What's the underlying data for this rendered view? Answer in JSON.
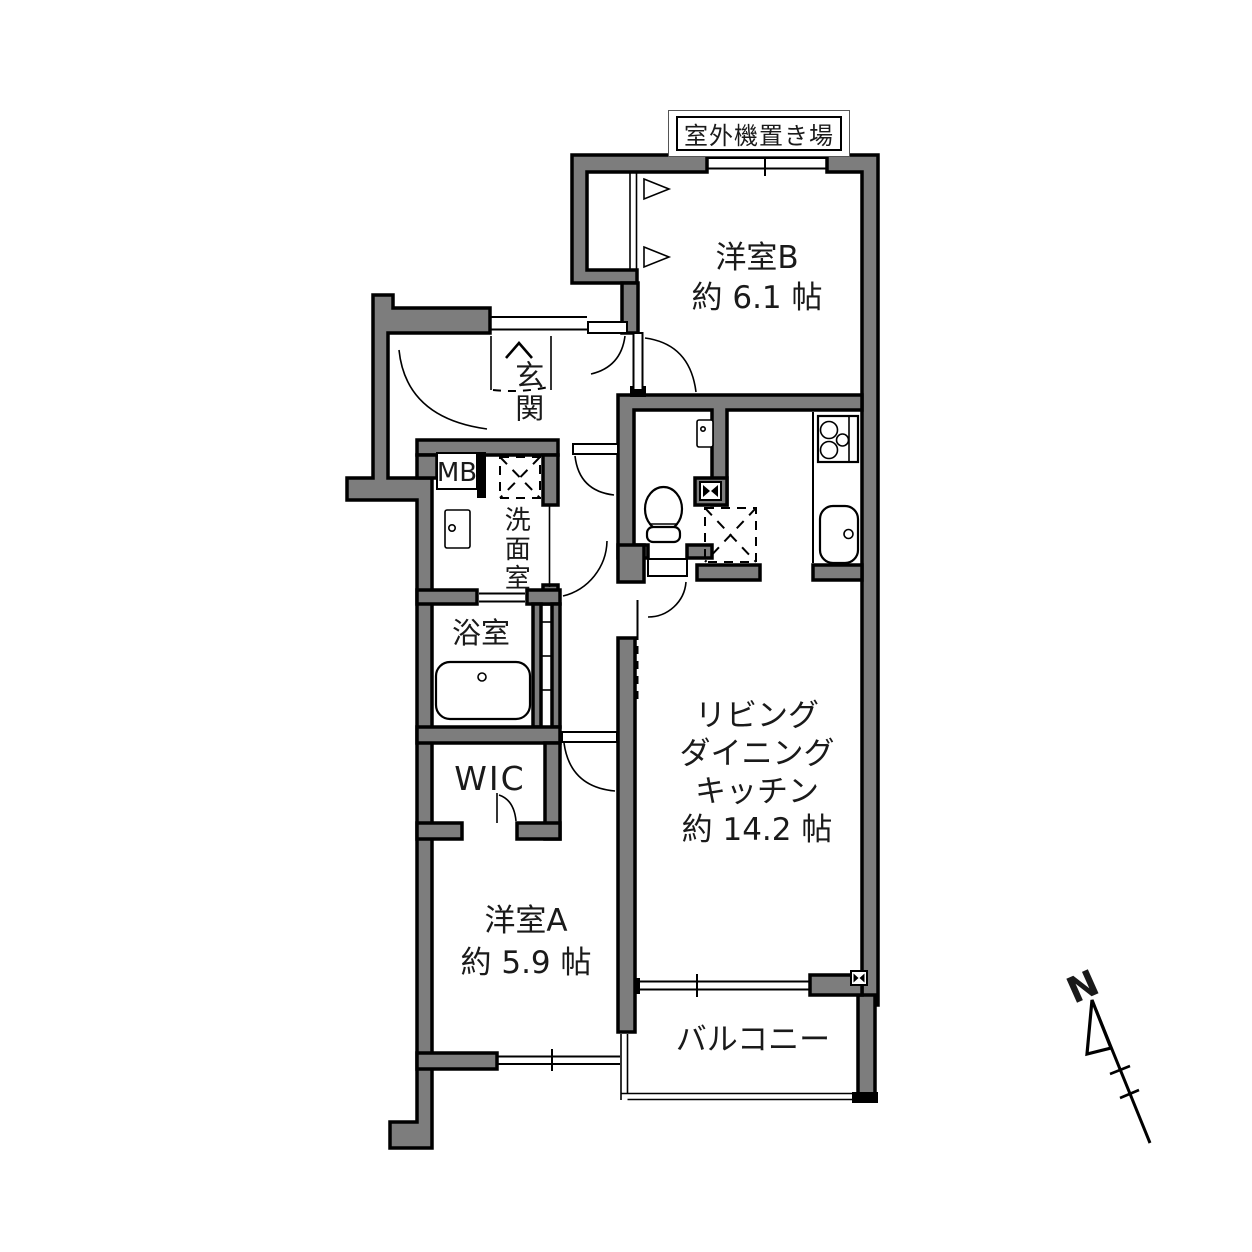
{
  "colors": {
    "wall_fill": "#7d7d7d",
    "line": "#000000",
    "background": "#ffffff"
  },
  "labels": {
    "outdoor_unit": "室外機置き場",
    "room_b_name": "洋室B",
    "room_b_size": "約 6.1 帖",
    "genkan": "玄関",
    "meter_box": "MB",
    "washroom": "洗面室",
    "bathroom": "浴室",
    "wic": "WIC",
    "room_a_name": "洋室A",
    "room_a_size": "約 5.9 帖",
    "ldk_line1": "リビング",
    "ldk_line2": "ダイニング",
    "ldk_line3": "キッチン",
    "ldk_size": "約 14.2 帖",
    "balcony": "バルコニー",
    "north_mark": "N"
  }
}
